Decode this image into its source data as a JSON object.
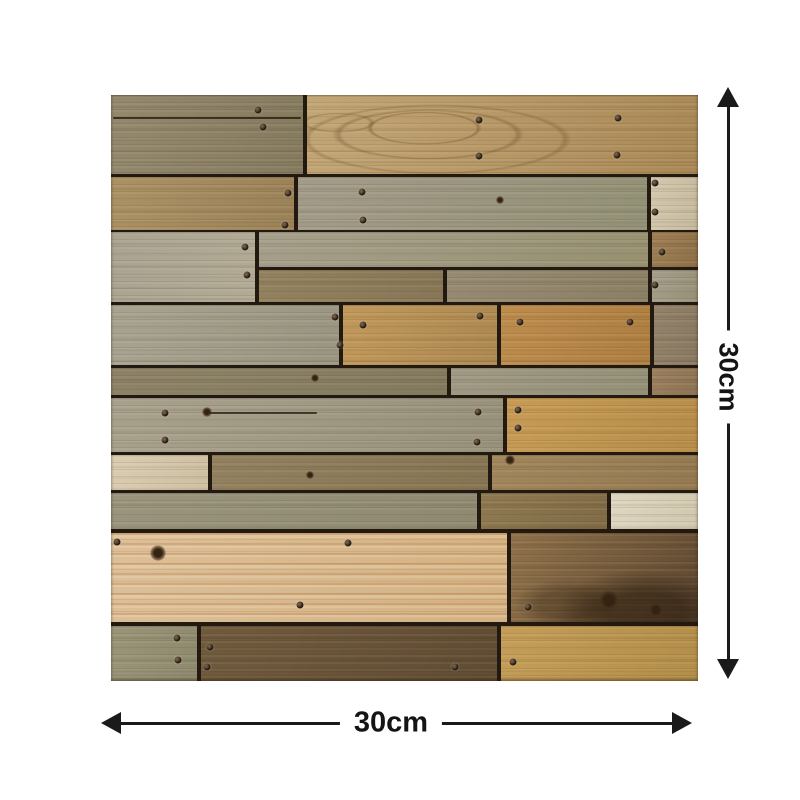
{
  "figure": {
    "type": "product-dimension-image",
    "subject": "reclaimed-wood-plank-panel",
    "width_label": "30cm",
    "height_label": "30cm"
  },
  "colors": {
    "page_background": "#ffffff",
    "dimension_color": "#1a1a1a",
    "label_color": "#141414",
    "seam_color": "#221a10"
  },
  "wood_panel": {
    "planks": [
      {
        "x": 0,
        "y": 0,
        "w": 192,
        "h": 79,
        "c1": "#94896d",
        "c2": "#857a5e"
      },
      {
        "x": 196,
        "y": 0,
        "w": 391,
        "h": 79,
        "c1": "#c3a676",
        "c2": "#a98855",
        "cls": "wavy"
      },
      {
        "x": 0,
        "y": 82,
        "w": 183,
        "h": 53,
        "c1": "#ab9164",
        "c2": "#9b8156"
      },
      {
        "x": 187,
        "y": 82,
        "w": 349,
        "h": 53,
        "c1": "#a39b89",
        "c2": "#929075"
      },
      {
        "x": 540,
        "y": 82,
        "w": 47,
        "h": 53,
        "c1": "#d3c8ae",
        "c2": "#c6b99d"
      },
      {
        "x": 0,
        "y": 137,
        "w": 144,
        "h": 70,
        "c1": "#a9a391",
        "c2": "#b2aa94"
      },
      {
        "x": 148,
        "y": 137,
        "w": 389,
        "h": 35,
        "c1": "#a59f8b",
        "c2": "#979170"
      },
      {
        "x": 541,
        "y": 137,
        "w": 46,
        "h": 35,
        "c1": "#9d7e53",
        "c2": "#8e7048"
      },
      {
        "x": 148,
        "y": 175,
        "w": 184,
        "h": 32,
        "c1": "#92815e",
        "c2": "#877655"
      },
      {
        "x": 336,
        "y": 175,
        "w": 201,
        "h": 32,
        "c1": "#968a72",
        "c2": "#8b7f64"
      },
      {
        "x": 541,
        "y": 175,
        "w": 46,
        "h": 32,
        "c1": "#a49d8b",
        "c2": "#989176"
      },
      {
        "x": 0,
        "y": 210,
        "w": 228,
        "h": 60,
        "c1": "#a8a390",
        "c2": "#999581"
      },
      {
        "x": 232,
        "y": 210,
        "w": 154,
        "h": 60,
        "c1": "#c09859",
        "c2": "#ad8850"
      },
      {
        "x": 390,
        "y": 210,
        "w": 149,
        "h": 60,
        "c1": "#bd8c4c",
        "c2": "#ae7e40"
      },
      {
        "x": 543,
        "y": 210,
        "w": 44,
        "h": 60,
        "c1": "#93826a",
        "c2": "#897861"
      },
      {
        "x": 0,
        "y": 273,
        "w": 336,
        "h": 27,
        "c1": "#8d8266",
        "c2": "#837a5e"
      },
      {
        "x": 340,
        "y": 273,
        "w": 197,
        "h": 27,
        "c1": "#9f9984",
        "c2": "#949077"
      },
      {
        "x": 541,
        "y": 273,
        "w": 46,
        "h": 27,
        "c1": "#9a7f5e",
        "c2": "#8d7352"
      },
      {
        "x": 0,
        "y": 303,
        "w": 392,
        "h": 54,
        "c1": "#a8a18c",
        "c2": "#97917b"
      },
      {
        "x": 396,
        "y": 303,
        "w": 191,
        "h": 54,
        "c1": "#c79b54",
        "c2": "#b78d49"
      },
      {
        "x": 0,
        "y": 360,
        "w": 97,
        "h": 35,
        "c1": "#daccb0",
        "c2": "#cebfa1"
      },
      {
        "x": 101,
        "y": 360,
        "w": 276,
        "h": 35,
        "c1": "#92815f",
        "c2": "#857451"
      },
      {
        "x": 381,
        "y": 360,
        "w": 206,
        "h": 35,
        "c1": "#a1865c",
        "c2": "#947950"
      },
      {
        "x": 0,
        "y": 398,
        "w": 366,
        "h": 36,
        "c1": "#9a947d",
        "c2": "#8e8970"
      },
      {
        "x": 370,
        "y": 398,
        "w": 126,
        "h": 36,
        "c1": "#8d784f",
        "c2": "#806b45"
      },
      {
        "x": 500,
        "y": 398,
        "w": 87,
        "h": 36,
        "c1": "#ded6c0",
        "c2": "#d1c8af"
      },
      {
        "x": 0,
        "y": 438,
        "w": 396,
        "h": 89,
        "c1": "#dcbf99",
        "c2": "#d3b183",
        "cls": "pine"
      },
      {
        "x": 400,
        "y": 438,
        "w": 187,
        "h": 89,
        "c1": "#8f7149",
        "c2": "#5e4730",
        "cls": "knotty"
      },
      {
        "x": 0,
        "y": 531,
        "w": 86,
        "h": 55,
        "c1": "#9a9578",
        "c2": "#8e896d"
      },
      {
        "x": 90,
        "y": 531,
        "w": 296,
        "h": 55,
        "c1": "#705a3d",
        "c2": "#604c32"
      },
      {
        "x": 390,
        "y": 531,
        "w": 197,
        "h": 55,
        "c1": "#c49d57",
        "c2": "#b38e49"
      }
    ],
    "nails": [
      {
        "x": 147,
        "y": 15
      },
      {
        "x": 152,
        "y": 32
      },
      {
        "x": 368,
        "y": 25
      },
      {
        "x": 368,
        "y": 61
      },
      {
        "x": 507,
        "y": 23
      },
      {
        "x": 506,
        "y": 60
      },
      {
        "x": 177,
        "y": 98
      },
      {
        "x": 174,
        "y": 130
      },
      {
        "x": 251,
        "y": 97
      },
      {
        "x": 252,
        "y": 125
      },
      {
        "x": 544,
        "y": 88
      },
      {
        "x": 544,
        "y": 117
      },
      {
        "x": 134,
        "y": 152
      },
      {
        "x": 136,
        "y": 180
      },
      {
        "x": 551,
        "y": 157
      },
      {
        "x": 544,
        "y": 190
      },
      {
        "x": 224,
        "y": 222
      },
      {
        "x": 252,
        "y": 230
      },
      {
        "x": 229,
        "y": 250
      },
      {
        "x": 369,
        "y": 221
      },
      {
        "x": 409,
        "y": 227
      },
      {
        "x": 519,
        "y": 227
      },
      {
        "x": 54,
        "y": 318
      },
      {
        "x": 54,
        "y": 345
      },
      {
        "x": 367,
        "y": 317
      },
      {
        "x": 366,
        "y": 347
      },
      {
        "x": 407,
        "y": 315
      },
      {
        "x": 407,
        "y": 333
      },
      {
        "x": 6,
        "y": 447
      },
      {
        "x": 237,
        "y": 448
      },
      {
        "x": 189,
        "y": 510
      },
      {
        "x": 417,
        "y": 512
      },
      {
        "x": 66,
        "y": 543
      },
      {
        "x": 67,
        "y": 565
      },
      {
        "x": 99,
        "y": 552
      },
      {
        "x": 96,
        "y": 572
      },
      {
        "x": 344,
        "y": 572
      },
      {
        "x": 402,
        "y": 567
      }
    ],
    "knots": [
      {
        "x": 96,
        "y": 317,
        "r": 5
      },
      {
        "x": 47,
        "y": 458,
        "r": 8
      },
      {
        "x": 399,
        "y": 365,
        "r": 5
      },
      {
        "x": 199,
        "y": 380,
        "r": 4
      },
      {
        "x": 498,
        "y": 505,
        "r": 10
      },
      {
        "x": 545,
        "y": 515,
        "r": 7
      },
      {
        "x": 204,
        "y": 283,
        "r": 4
      },
      {
        "x": 389,
        "y": 105,
        "r": 4
      }
    ],
    "cracks": [
      {
        "x": 2,
        "y": 22,
        "w": 188
      },
      {
        "x": 96,
        "y": 317,
        "w": 110
      }
    ]
  }
}
